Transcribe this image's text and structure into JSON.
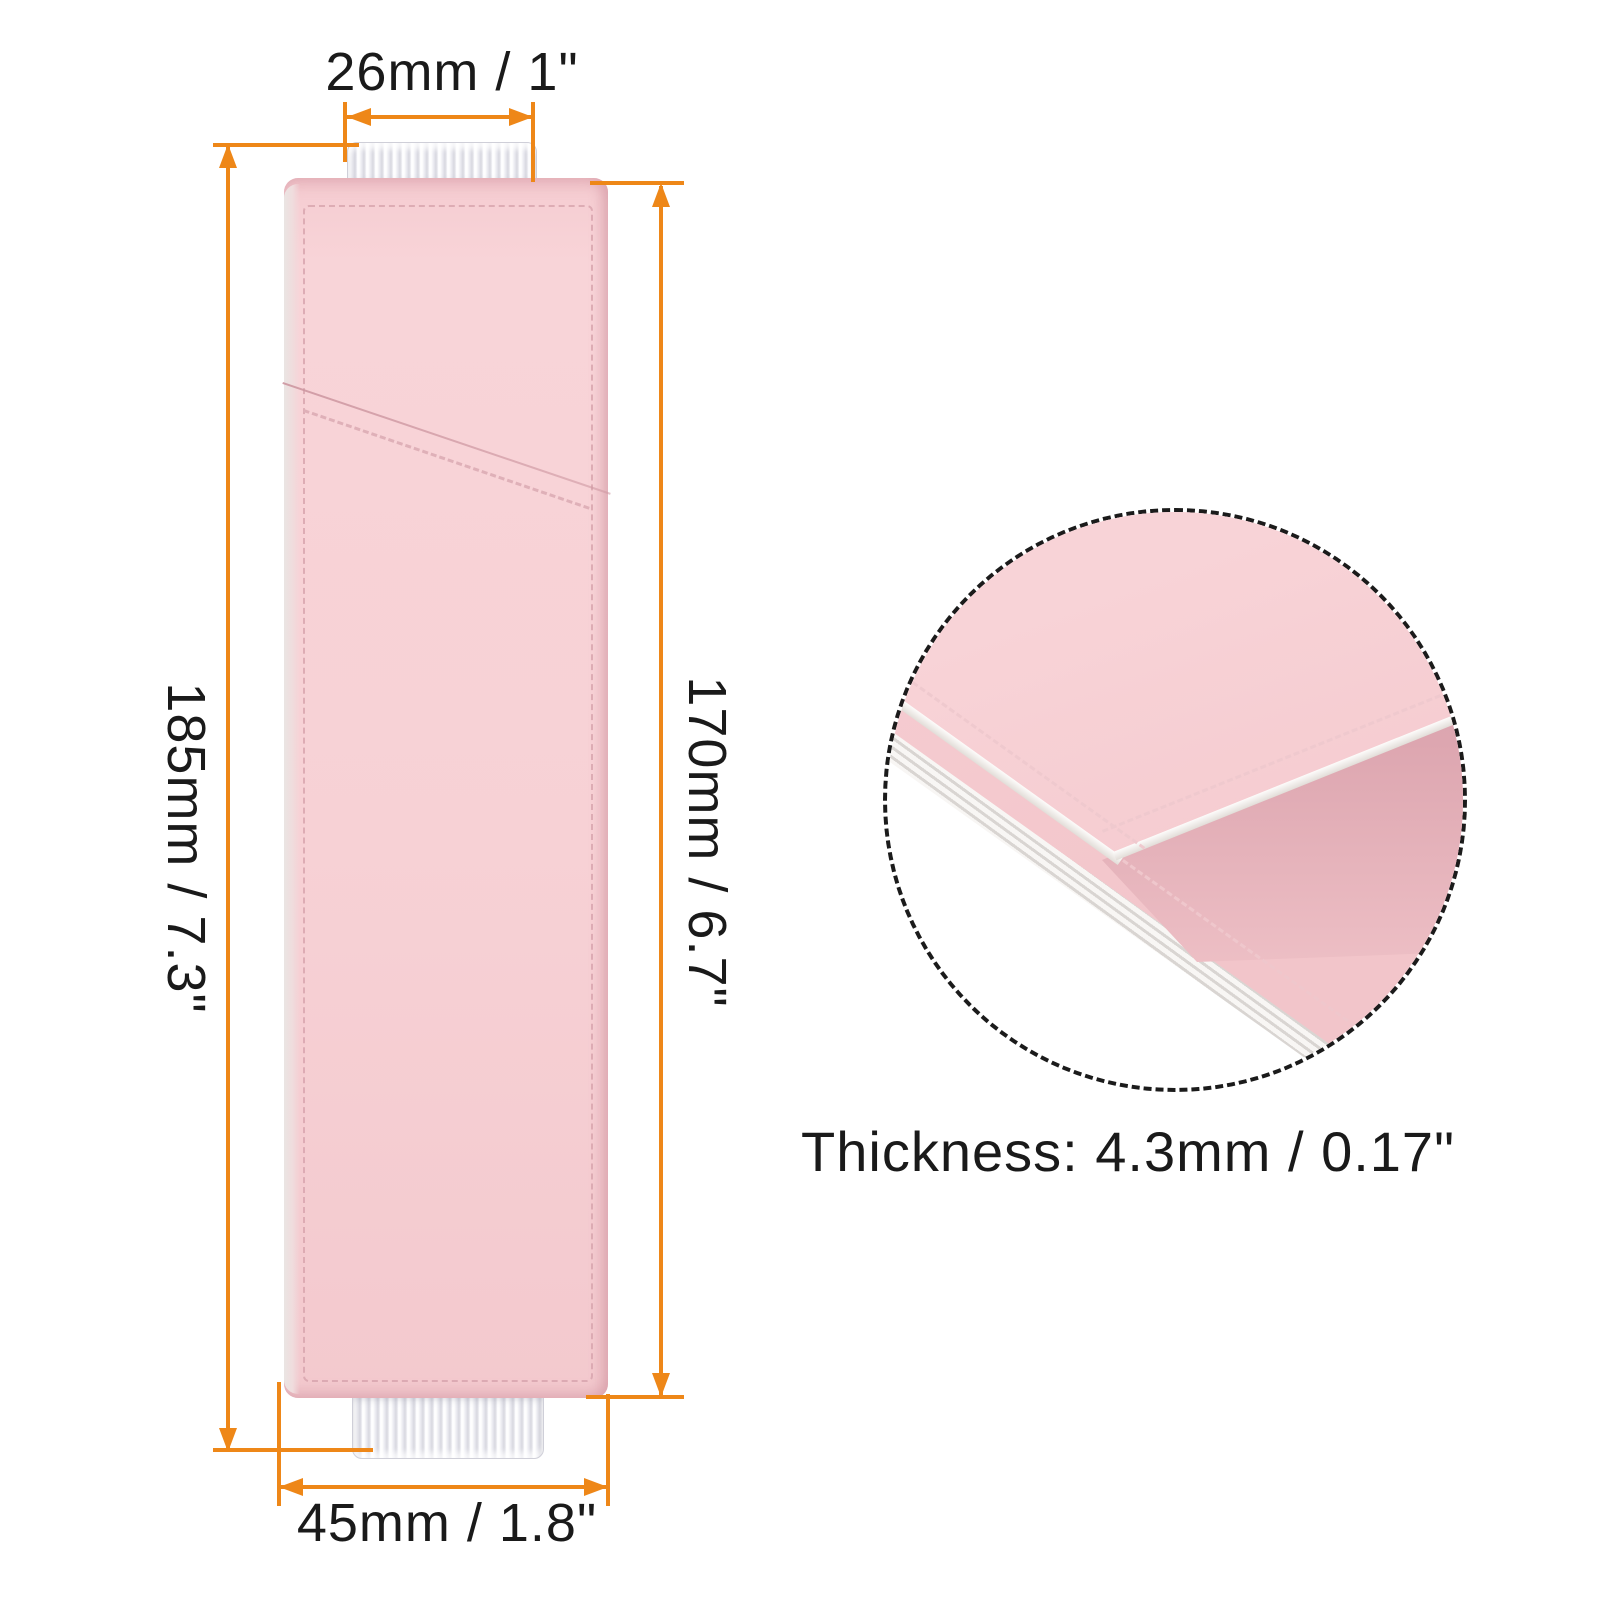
{
  "title": "Pen sleeve holder dimension diagram",
  "labels": {
    "top_width": "26mm / 1\"",
    "overall_height": "185mm / 7.3\"",
    "body_height": "170mm / 6.7\"",
    "bottom_width": "45mm / 1.8\"",
    "thickness": "Thickness: 4.3mm / 0.17\""
  },
  "colors": {
    "accent": "#ee8718",
    "text": "#1a1a1a",
    "leather": "#f7d1d5",
    "leather-shade": "#eec1c8",
    "leather-interior": "#d49ba7",
    "stitch": "#dfb0b8",
    "elastic-light": "#ffffff",
    "elastic-dark": "#d7d7df",
    "edge-gray": "#eae5e3",
    "circle-border": "#1b1b1b",
    "background": "#ffffff"
  }
}
